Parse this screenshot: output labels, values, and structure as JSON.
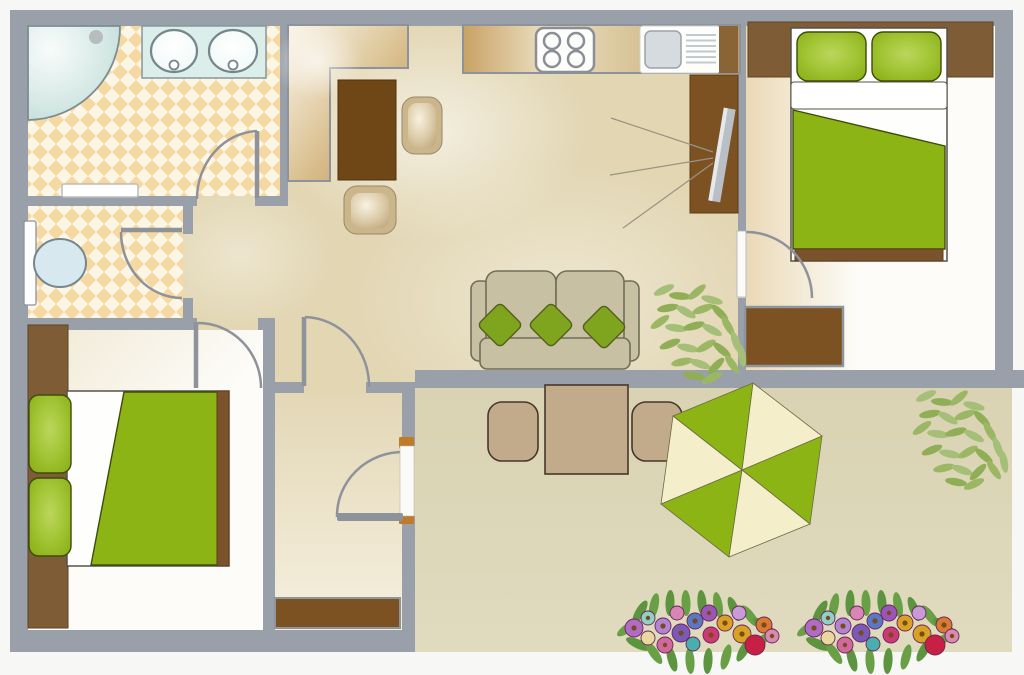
{
  "plan": {
    "type": "apartment-floor-plan",
    "rooms": [
      {
        "name": "bathroom",
        "floor": "diamond-tile"
      },
      {
        "name": "toilet-room",
        "floor": "diamond-tile"
      },
      {
        "name": "kitchen-dining",
        "floor": "beige"
      },
      {
        "name": "living-room",
        "floor": "beige"
      },
      {
        "name": "master-bedroom",
        "floor": "white"
      },
      {
        "name": "second-bedroom",
        "floor": "white"
      },
      {
        "name": "entrance-hall",
        "floor": "cream"
      },
      {
        "name": "terrace",
        "floor": "khaki"
      }
    ],
    "furniture": {
      "bathroom": [
        "corner-bathtub",
        "double-sink-vanity",
        "bath-mat"
      ],
      "toilet_room": [
        "toilet-with-tank"
      ],
      "kitchen": [
        "l-shaped-counter",
        "dining-table",
        "dining-chair",
        "dining-chair",
        "stove-4-burners",
        "sink-with-drainboard"
      ],
      "living_room": [
        "sofa-with-3-pillows",
        "tv-cabinet",
        "tv",
        "potted-plant"
      ],
      "master_bedroom": [
        "headboard",
        "double-bed-green-blanket",
        "pillow",
        "pillow",
        "dresser"
      ],
      "second_bedroom": [
        "headboard",
        "double-bed-green-blanket",
        "pillow",
        "pillow"
      ],
      "entrance_hall": [
        "sideboard",
        "entrance-door"
      ],
      "terrace": [
        "square-table",
        "chair",
        "chair",
        "parasol-hexagonal",
        "plant",
        "flower-bed",
        "flower-bed"
      ]
    },
    "doors_count": 6,
    "windows_count": 0
  },
  "colors": {
    "wall": "#9aa0a9",
    "floor_main": "#e2d6b3",
    "floor_terrace": "#dcd6b7",
    "tile_base": "#fcf6e6",
    "tile_diamond": "#f6d9a2",
    "green": "#8cb414",
    "green_sofa_pillow": "#7fa41e",
    "cream_umbrella": "#f4eecb",
    "brown": "#7e5d36",
    "brown_dark": "#6f4716",
    "brown_mid": "#8a6434",
    "brown_tv": "#7c5222",
    "sofa": "#c8c0a2",
    "tan_furniture": "#c2ab8b",
    "tub_blue": "#c9e2dd",
    "fixture_white": "#fdfdfc",
    "steel": "#d6dbdf",
    "hinge_orange": "#c07a28",
    "leaf": "#9ab065",
    "flower_leaf": "#69a046"
  }
}
